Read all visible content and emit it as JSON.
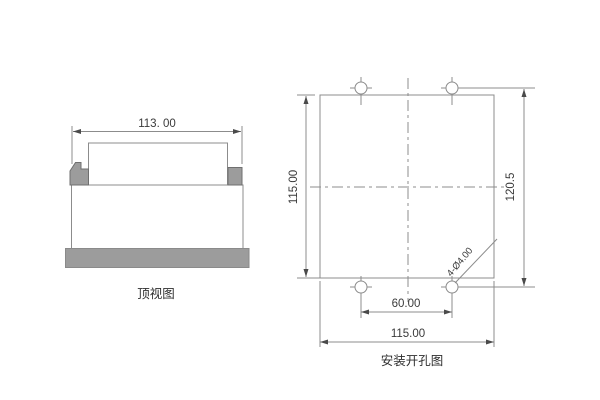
{
  "colors": {
    "line": "#8c8c8c",
    "device_fill": "#9c9c9c",
    "text": "#3a3a3a",
    "background": "#ffffff"
  },
  "top_view": {
    "caption": "顶视图",
    "width_label": "113. 00"
  },
  "mounting_view": {
    "caption": "安装开孔图",
    "cutout_height_label": "115.00",
    "hole_pitch_height_label": "120.5",
    "hole_pitch_width_label": "60.00",
    "cutout_width_label": "115.00",
    "holes_note_label": "4-Ø4.00"
  }
}
